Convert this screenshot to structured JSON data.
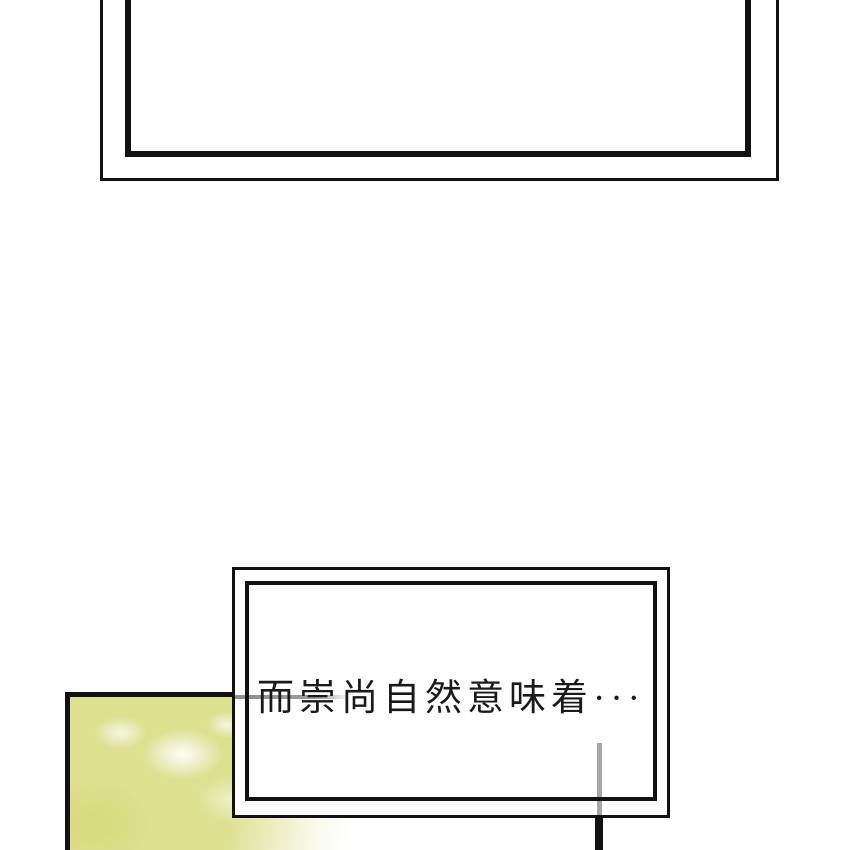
{
  "page": {
    "background_color": "#ffffff",
    "ink_color": "#111111"
  },
  "speech_box": {
    "text": "而崇尚自然意味着···"
  },
  "photo_panel": {
    "content": "blurred-foliage-texture",
    "base_color": "#dce08f",
    "highlight_color": "#ffffff"
  },
  "connector_lines": {
    "gray_color": "#9c9c9c",
    "black_color": "#111111"
  }
}
